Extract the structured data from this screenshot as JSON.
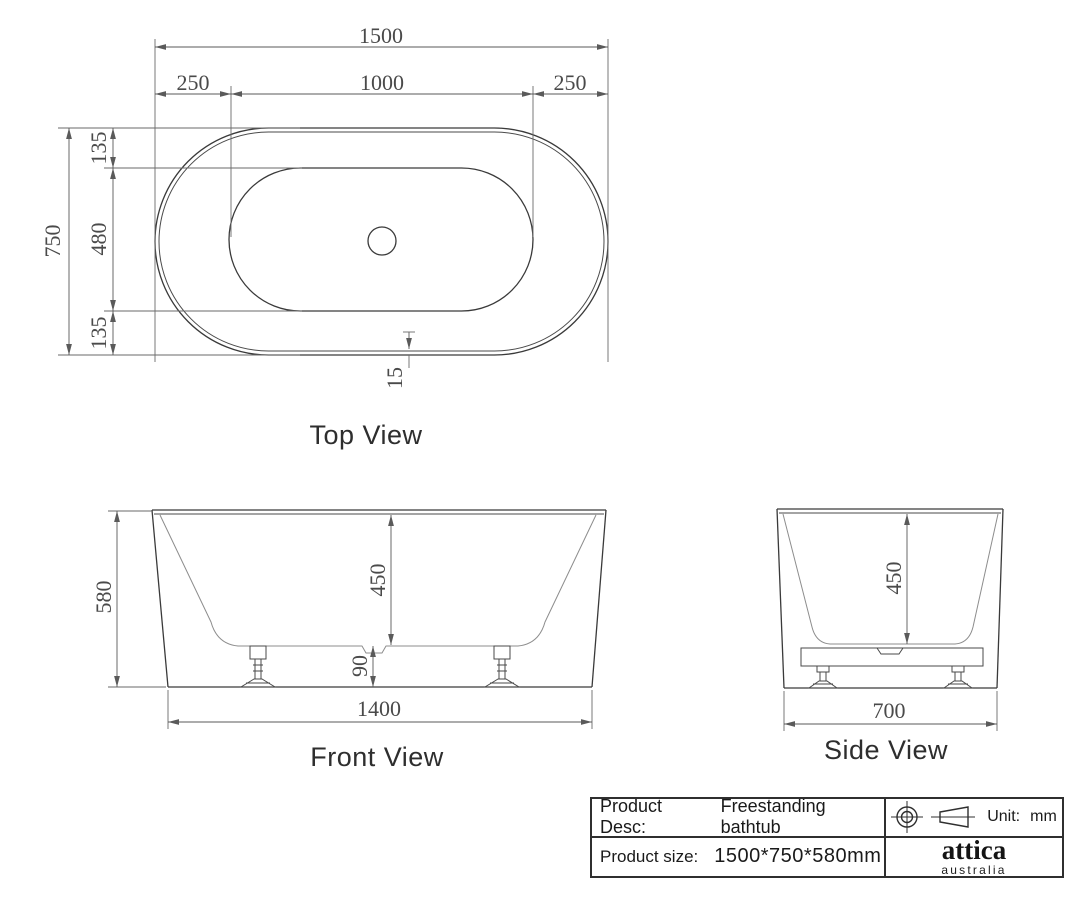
{
  "views": {
    "top": {
      "label": "Top View",
      "width_total": "1500",
      "seg_left": "250",
      "seg_mid": "1000",
      "seg_right": "250",
      "depth_total": "750",
      "edge_top": "135",
      "basin_depth": "480",
      "edge_bottom": "135",
      "wall_thickness": "15"
    },
    "front": {
      "label": "Front View",
      "height": "580",
      "inner_depth": "450",
      "floor_gap": "90",
      "base_width": "1400"
    },
    "side": {
      "label": "Side View",
      "inner_depth": "450",
      "base_width": "700"
    }
  },
  "title_block": {
    "desc_label": "Product Desc:",
    "desc_value": "Freestanding bathtub",
    "unit_label": "Unit:",
    "unit_value": "mm",
    "size_label": "Product size:",
    "size_value": "1500*750*580mm",
    "brand_name": "attica",
    "brand_sub": "australia"
  },
  "colors": {
    "background": "#ffffff",
    "outline": "#3a3a3a",
    "dimension": "#5a5a5a",
    "dim_text": "#4a4a4a"
  },
  "icons": {
    "projection_circle": "first-angle-projection-circle",
    "projection_cone": "first-angle-projection-cone"
  }
}
